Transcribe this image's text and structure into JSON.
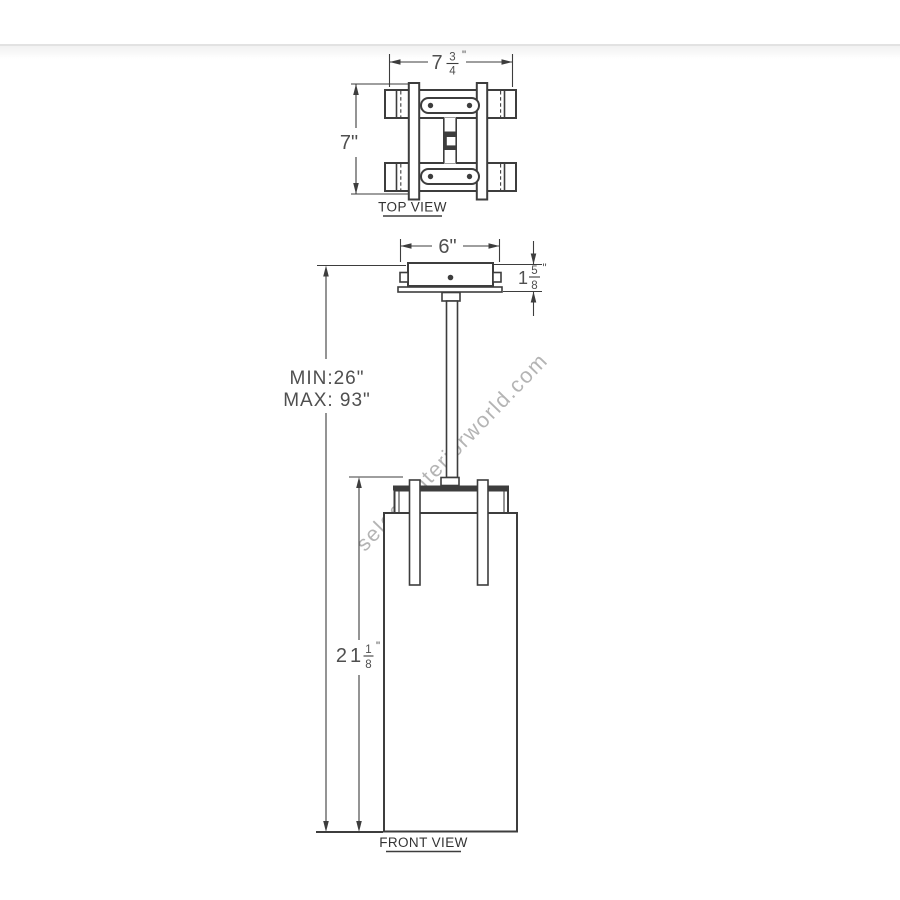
{
  "page": {
    "watermark": "select-interiorworld.com"
  },
  "colors": {
    "background": "#ffffff",
    "drawing_line": "#3d3d3d",
    "dimension_text": "#4f4f4f",
    "label_text": "#333333",
    "watermark_text": "#a8a8a8",
    "header_divider": "#e2e2e2",
    "shade_dots": "#5a5a5a"
  },
  "top_view": {
    "label": "TOP VIEW",
    "width_dim": {
      "whole": "7",
      "num": "3",
      "den": "4",
      "unit": "\""
    },
    "height_dim": "7\""
  },
  "front_view": {
    "label": "FRONT VIEW",
    "canopy_width_dim": "6\"",
    "canopy_height_dim": {
      "whole": "1",
      "num": "5",
      "den": "8",
      "unit": "\""
    },
    "suspension": {
      "min": "MIN:26\"",
      "max": "MAX: 93\""
    },
    "shade_height_dim": {
      "whole": "21",
      "num": "1",
      "den": "8",
      "unit": "\""
    }
  }
}
